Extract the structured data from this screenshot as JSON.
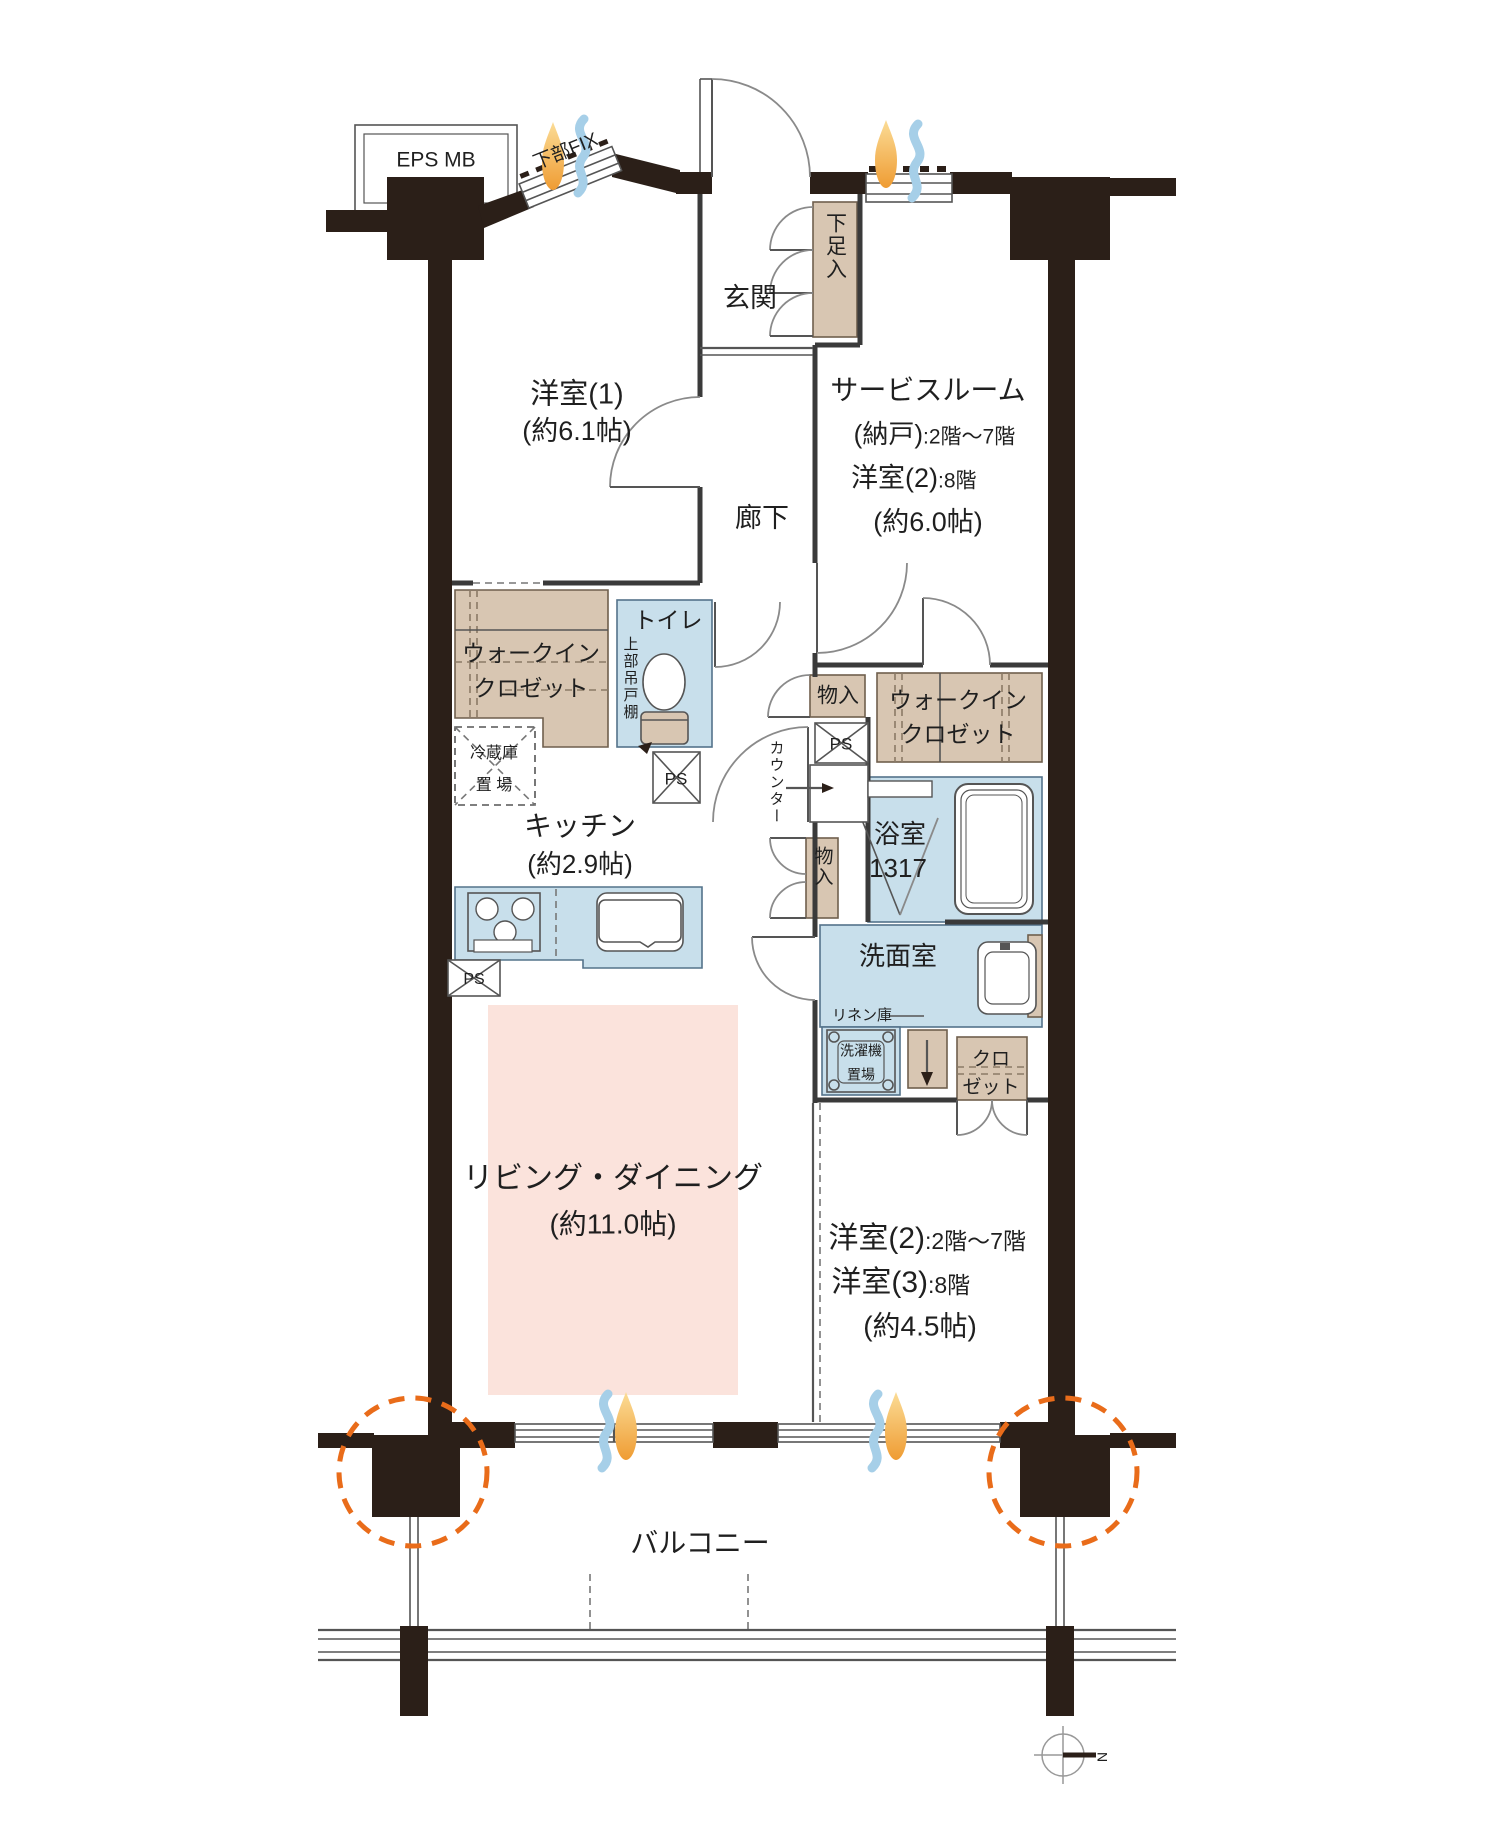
{
  "labels": {
    "eps_mb": "EPS MB",
    "lower_fix": "下部FIX",
    "entrance": "玄関",
    "shoe_cabinet": "下足入",
    "western_room_1": {
      "name": "洋室(1)",
      "size": "(約6.1帖)"
    },
    "service_room": {
      "name": "サービスルーム",
      "storage": "(納戸)",
      "storage_floors": ":2階〜7階",
      "room8": "洋室(2)",
      "room8_floors": ":8階",
      "size": "(約6.0帖)"
    },
    "hallway": "廊下",
    "walk_in_closet": {
      "line1": "ウォークイン",
      "line2": "クロゼット"
    },
    "toilet": {
      "name": "トイレ",
      "upper_shelf": "上部吊戸棚"
    },
    "refrigerator_space": {
      "line1": "冷蔵庫",
      "line2": "置 場"
    },
    "kitchen": {
      "name": "キッチン",
      "size": "(約2.9帖)"
    },
    "counter": "カウンター",
    "storage": "物入",
    "ps": "PS",
    "bathroom": {
      "name": "浴室",
      "size": "1317"
    },
    "washroom": "洗面室",
    "linen": "リネン庫",
    "washer_space": {
      "line1": "洗濯機",
      "line2": "置場"
    },
    "closet": {
      "line1": "クロ",
      "line2": "ゼット"
    },
    "living_dining": {
      "name": "リビング・ダイニング",
      "size": "(約11.0帖)"
    },
    "western_room_2_3": {
      "r2": "洋室(2)",
      "r2_floors": ":2階〜7階",
      "r3": "洋室(3)",
      "r3_floors": ":8階",
      "size": "(約4.5帖)"
    },
    "balcony": "バルコニー",
    "north": "N"
  },
  "colors": {
    "wall": "#2b1f18",
    "storage_fill": "#d8c6b2",
    "wet_area_fill": "#c8dfeb",
    "living_fill": "#fbe3dc",
    "pillar_highlight": "#e96c1a",
    "flame": "#f2a33c",
    "airflow": "#a6cfe8"
  }
}
